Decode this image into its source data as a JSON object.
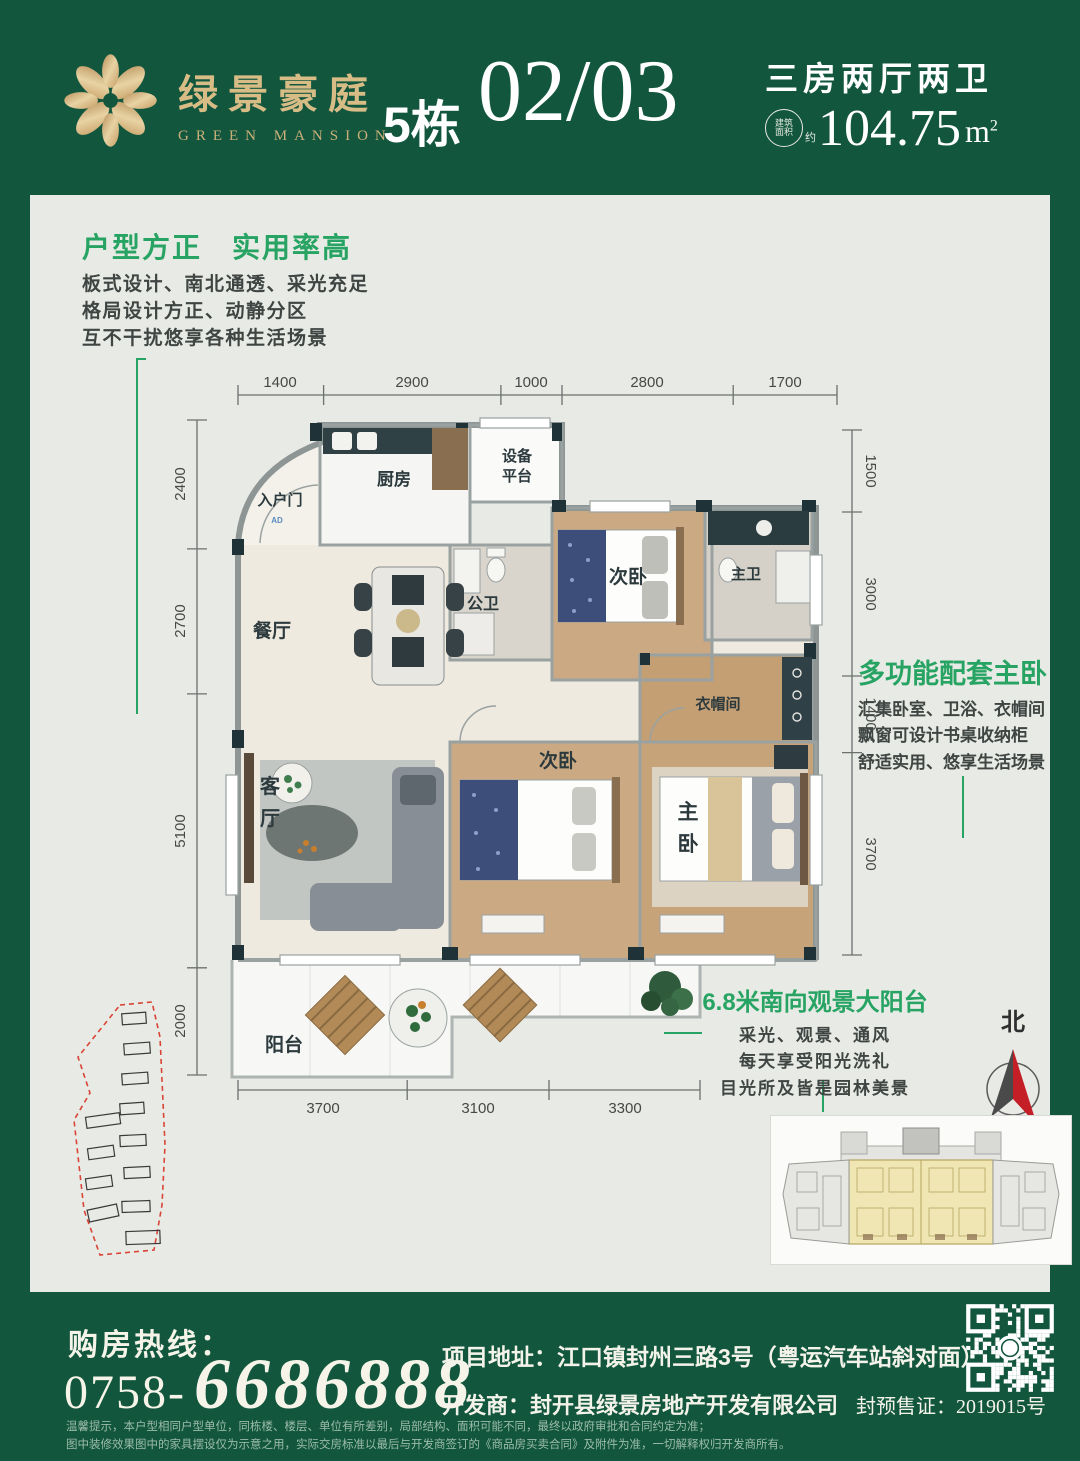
{
  "colors": {
    "brand_green": "#12563E",
    "accent_green": "#27A463",
    "gold": "#D8BC85"
  },
  "header": {
    "brand_cn": "绿景豪庭",
    "brand_en": "GREEN MANSION",
    "block_label": "5栋",
    "unit_number": "02/03",
    "layout_type": "三房两厅两卫",
    "area_badge_line1": "建筑",
    "area_badge_line2": "面积",
    "area_badge_approx": "约",
    "area_value": "104.75",
    "area_unit": "m",
    "area_sup": "2"
  },
  "left_callout": {
    "title": "户型方正　实用率高",
    "line1": "板式设计、南北通透、采光充足",
    "line2": "格局设计方正、动静分区",
    "line3": "互不干扰悠享各种生活场景"
  },
  "master_callout": {
    "title": "多功能配套主卧",
    "line1": "汇集卧室、卫浴、衣帽间",
    "line2": "飘窗可设计书桌收纳柜",
    "line3": "舒适实用、悠享生活场景"
  },
  "balcony_callout": {
    "title": "6.8米南向观景大阳台",
    "line1": "采光、观景、通风",
    "line2": "每天享受阳光洗礼",
    "line3": "目光所及皆是园林美景"
  },
  "floorplan": {
    "rooms": {
      "entry": "入户门",
      "entry_marker": "AD",
      "kitchen": "厨房",
      "equipment_line1": "设备",
      "equipment_line2": "平台",
      "guest_bath": "公卫",
      "dining": "餐厅",
      "bedroom_top": "次卧",
      "master_bath": "主卫",
      "closet": "衣帽间",
      "living_line1": "客",
      "living_line2": "厅",
      "bedroom_mid": "次卧",
      "master_line1": "主",
      "master_line2": "卧",
      "balcony": "阳台"
    },
    "dims_top": [
      "1400",
      "2900",
      "1000",
      "2800",
      "1700"
    ],
    "dims_left": [
      "2400",
      "2700",
      "5100",
      "2000"
    ],
    "dims_right": [
      "1500",
      "3000",
      "1400",
      "3700"
    ],
    "dims_bottom": [
      "3700",
      "3100",
      "3300"
    ]
  },
  "compass": {
    "label": "北"
  },
  "footer": {
    "hotline_label": "购房热线：",
    "phone_prefix": "0758-",
    "phone_number": "6686888",
    "address": "项目地址：江口镇封州三路3号（粤运汽车站斜对面）",
    "developer": "开发商：封开县绿景房地产开发有限公司",
    "permit": "封预售证：2019015号",
    "disclaimer_line1": "温馨提示，本户型相同户型单位，同栋楼、楼层、单位有所差别，局部结构、面积可能不同，最终以政府审批和合同约定为准；",
    "disclaimer_line2": "图中装修效果图中的家具摆设仅为示意之用，实际交房标准以最后与开发商签订的《商品房买卖合同》及附件为准，一切解释权归开发商所有。"
  }
}
